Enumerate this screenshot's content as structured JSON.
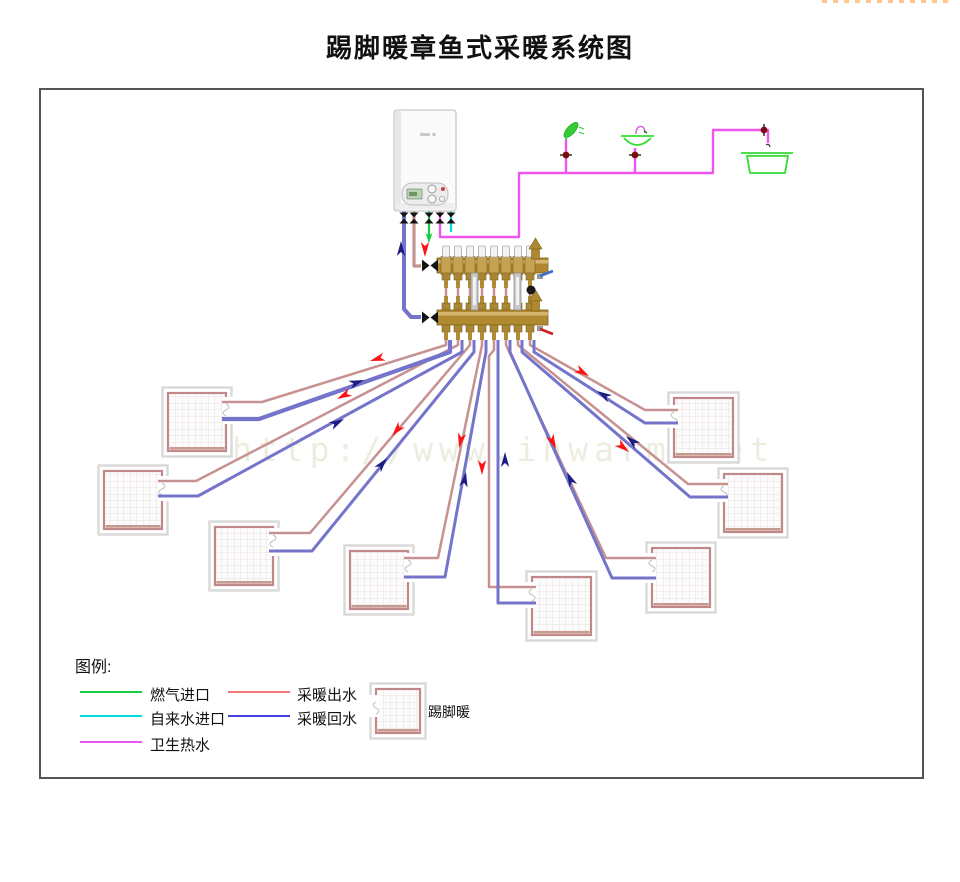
{
  "title": "踢脚暖章鱼式采暖系统图",
  "watermark": "http://www.inwarm.net",
  "colors": {
    "supply_pipe": "#c79191",
    "return_pipe": "#7474cb",
    "gas": "#19cc44",
    "tap": "#00dcdc",
    "dhw": "#ee55ee",
    "fixture": "#33dd33",
    "arrow_supply": "#ff1212",
    "arrow_return": "#1c1c82",
    "brass": "#b0882f",
    "brass_dark": "#7d621f",
    "brass_light": "#d9bd78",
    "room_wall": "#c08888",
    "room_frame": "#d9d9d9",
    "room_grid": "#e9dede"
  },
  "legend": {
    "heading": "图例:",
    "items": [
      {
        "id": "gas-inlet",
        "label": "燃气进口",
        "color": "#19cc44"
      },
      {
        "id": "tap-water-inlet",
        "label": "自来水进口",
        "color": "#00dcdc"
      },
      {
        "id": "sanitary-hot-water",
        "label": "卫生热水",
        "color": "#ee55ee"
      },
      {
        "id": "heating-supply",
        "label": "采暖出水",
        "color": "#f07878"
      },
      {
        "id": "heating-return",
        "label": "采暖回水",
        "color": "#4444dd"
      }
    ],
    "room_symbol_label": "踢脚暖"
  },
  "diagram": {
    "rooms": [
      {
        "x": 168,
        "y": 393,
        "w": 58,
        "h": 58,
        "side": "right",
        "py": 402,
        "by": 419
      },
      {
        "x": 104,
        "y": 471,
        "w": 58,
        "h": 58,
        "side": "right",
        "py": 481,
        "by": 496
      },
      {
        "x": 215,
        "y": 527,
        "w": 58,
        "h": 58,
        "side": "right",
        "py": 533,
        "by": 551
      },
      {
        "x": 350,
        "y": 551,
        "w": 58,
        "h": 58,
        "side": "right",
        "py": 558,
        "by": 577
      },
      {
        "x": 532,
        "y": 577,
        "w": 59,
        "h": 58,
        "side": "left",
        "py": 587,
        "by": 603
      },
      {
        "x": 652,
        "y": 548,
        "w": 58,
        "h": 59,
        "side": "left",
        "py": 558,
        "by": 578
      },
      {
        "x": 724,
        "y": 474,
        "w": 58,
        "h": 58,
        "side": "left",
        "py": 484,
        "by": 497
      },
      {
        "x": 674,
        "y": 398,
        "w": 59,
        "h": 59,
        "side": "left",
        "py": 410,
        "by": 423
      }
    ],
    "legend_room": {
      "x": 376,
      "y": 689,
      "w": 44,
      "h": 44,
      "side": "left",
      "py": 700,
      "by": 712
    },
    "supply_pipes": [
      [
        [
          446,
          287
        ],
        [
          446,
          345
        ],
        [
          262,
          402
        ],
        [
          222,
          402
        ]
      ],
      [
        [
          458,
          287
        ],
        [
          458,
          345
        ],
        [
          196,
          481
        ],
        [
          158,
          481
        ]
      ],
      [
        [
          470,
          287
        ],
        [
          470,
          345
        ],
        [
          310,
          533
        ],
        [
          269,
          533
        ]
      ],
      [
        [
          482,
          287
        ],
        [
          482,
          345
        ],
        [
          438,
          558
        ],
        [
          404,
          558
        ]
      ],
      [
        [
          494,
          287
        ],
        [
          494,
          350
        ],
        [
          489,
          356
        ],
        [
          489,
          587
        ],
        [
          536,
          587
        ]
      ],
      [
        [
          506,
          287
        ],
        [
          506,
          345
        ],
        [
          606,
          558
        ],
        [
          656,
          558
        ]
      ],
      [
        [
          518,
          287
        ],
        [
          518,
          345
        ],
        [
          688,
          484
        ],
        [
          728,
          484
        ]
      ],
      [
        [
          530,
          287
        ],
        [
          530,
          345
        ],
        [
          645,
          410
        ],
        [
          678,
          410
        ]
      ]
    ],
    "return_pipes": [
      {
        "w": 4.2,
        "pts": [
          [
            450,
            340
          ],
          [
            450,
            352
          ],
          [
            259,
            419
          ],
          [
            222,
            419
          ]
        ]
      },
      {
        "w": 3,
        "pts": [
          [
            462,
            340
          ],
          [
            462,
            352
          ],
          [
            198,
            496
          ],
          [
            158,
            496
          ]
        ]
      },
      {
        "w": 3,
        "pts": [
          [
            474,
            340
          ],
          [
            474,
            352
          ],
          [
            312,
            551
          ],
          [
            269,
            551
          ]
        ]
      },
      {
        "w": 3,
        "pts": [
          [
            486,
            340
          ],
          [
            486,
            352
          ],
          [
            445,
            577
          ],
          [
            404,
            577
          ]
        ]
      },
      {
        "w": 3,
        "pts": [
          [
            498,
            340
          ],
          [
            498,
            603
          ],
          [
            536,
            603
          ]
        ]
      },
      {
        "w": 3,
        "pts": [
          [
            510,
            340
          ],
          [
            510,
            352
          ],
          [
            612,
            578
          ],
          [
            656,
            578
          ]
        ]
      },
      {
        "w": 3,
        "pts": [
          [
            522,
            340
          ],
          [
            522,
            352
          ],
          [
            690,
            497
          ],
          [
            728,
            497
          ]
        ]
      },
      {
        "w": 3,
        "pts": [
          [
            534,
            340
          ],
          [
            534,
            352
          ],
          [
            645,
            423
          ],
          [
            678,
            423
          ]
        ]
      }
    ],
    "manifold": {
      "outlets_x": [
        446,
        458,
        470,
        482,
        494,
        506,
        518,
        530
      ],
      "bar_x": 437,
      "bar_w": 111,
      "upper_y": 258,
      "lower_y": 310,
      "flow_meters_x": [
        471,
        514
      ]
    },
    "arrows": [
      {
        "x": 425,
        "y": 257,
        "a": 90,
        "t": "s"
      },
      {
        "x": 401,
        "y": 241,
        "a": -90,
        "t": "r"
      },
      {
        "x": 370,
        "y": 361,
        "a": 163,
        "t": "s"
      },
      {
        "x": 364,
        "y": 380,
        "a": -19,
        "t": "r"
      },
      {
        "x": 337,
        "y": 399,
        "a": 153,
        "t": "s"
      },
      {
        "x": 344,
        "y": 419,
        "a": -28,
        "t": "r"
      },
      {
        "x": 392,
        "y": 436,
        "a": 130,
        "t": "s"
      },
      {
        "x": 387,
        "y": 458,
        "a": -51,
        "t": "r"
      },
      {
        "x": 459,
        "y": 448,
        "a": 102,
        "t": "s"
      },
      {
        "x": 466,
        "y": 472,
        "a": -80,
        "t": "r"
      },
      {
        "x": 482,
        "y": 475,
        "a": 90,
        "t": "s"
      },
      {
        "x": 505,
        "y": 452,
        "a": -90,
        "t": "r"
      },
      {
        "x": 556,
        "y": 449,
        "a": 65,
        "t": "s"
      },
      {
        "x": 567,
        "y": 472,
        "a": -115,
        "t": "r"
      },
      {
        "x": 629,
        "y": 452,
        "a": 39,
        "t": "s"
      },
      {
        "x": 626,
        "y": 436,
        "a": -140,
        "t": "r"
      },
      {
        "x": 589,
        "y": 376,
        "a": 30,
        "t": "s"
      },
      {
        "x": 597,
        "y": 391,
        "a": -149,
        "t": "r"
      }
    ]
  }
}
